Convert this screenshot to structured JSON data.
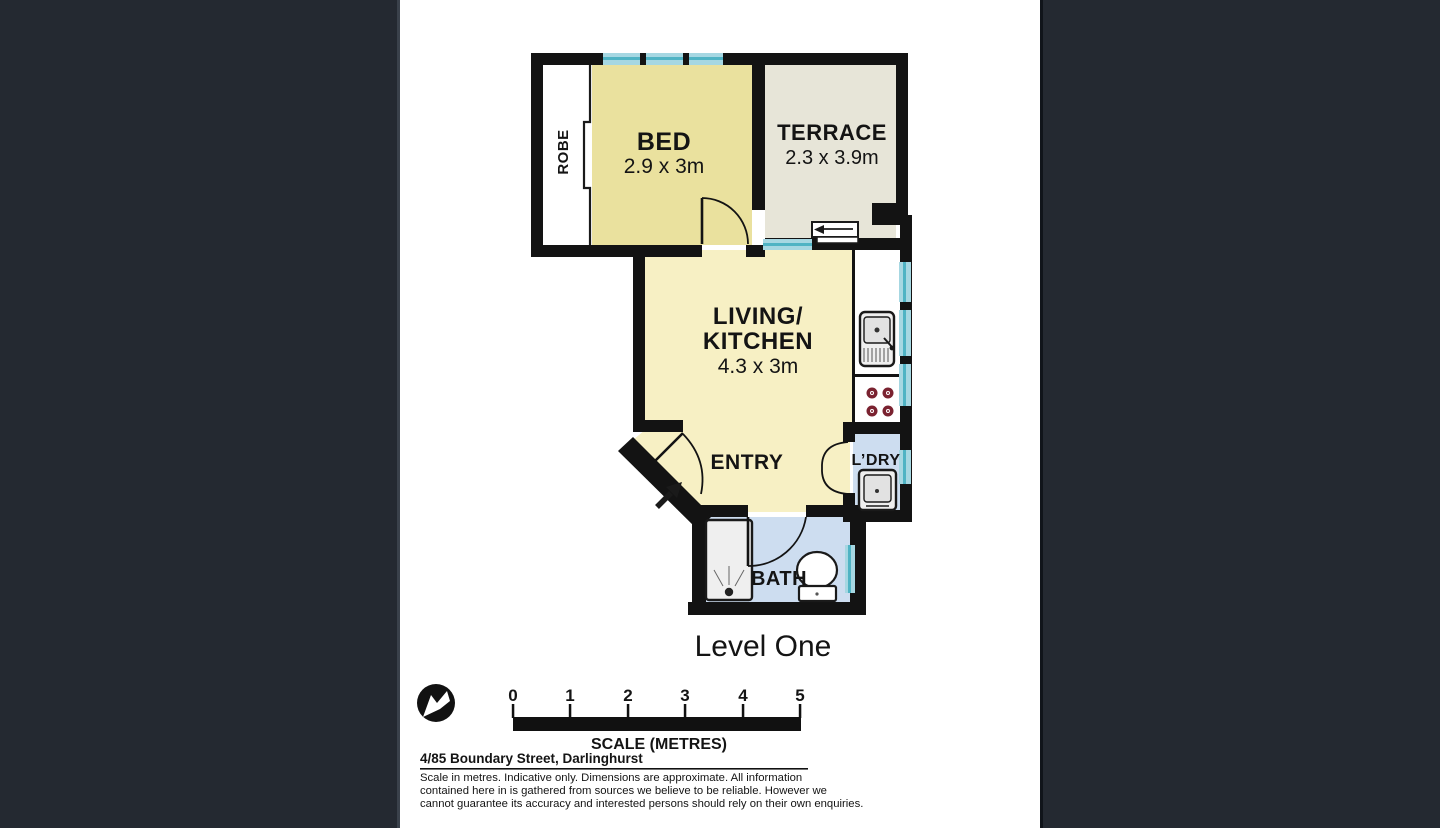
{
  "colors": {
    "wall": "#131313",
    "bed": "#eae19e",
    "terrace": "#e7e5d8",
    "living": "#f7f0c4",
    "wet": "#cdddf0",
    "window": "#a6d7e2",
    "window_stripe": "#4fb3c4",
    "burner": "#7a2230",
    "fixture_fill": "#efefef",
    "page_bg": "#242931",
    "canvas_bg": "#ffffff"
  },
  "floorplan": {
    "level_label": "Level One",
    "rooms": {
      "robe": {
        "label": "ROBE"
      },
      "bed": {
        "label": "BED",
        "dims": "2.9 x 3m"
      },
      "terrace": {
        "label": "TERRACE",
        "dims": "2.3 x 3.9m"
      },
      "living": {
        "line1": "LIVING/",
        "line2": "KITCHEN",
        "dims": "4.3 x 3m"
      },
      "entry": {
        "label": "ENTRY"
      },
      "laundry": {
        "label": "L’DRY"
      },
      "bath": {
        "label": "BATH"
      }
    }
  },
  "scalebar": {
    "ticks": [
      "0",
      "1",
      "2",
      "3",
      "4",
      "5"
    ],
    "caption": "SCALE (METRES)"
  },
  "footer": {
    "address": "4/85 Boundary Street, Darlinghurst",
    "disclaimer": [
      "Scale in metres. Indicative only. Dimensions are approximate. All information",
      "contained here in is gathered from sources we believe to be reliable. However we",
      "cannot guarantee its accuracy and interested persons should rely on their own enquiries."
    ]
  }
}
